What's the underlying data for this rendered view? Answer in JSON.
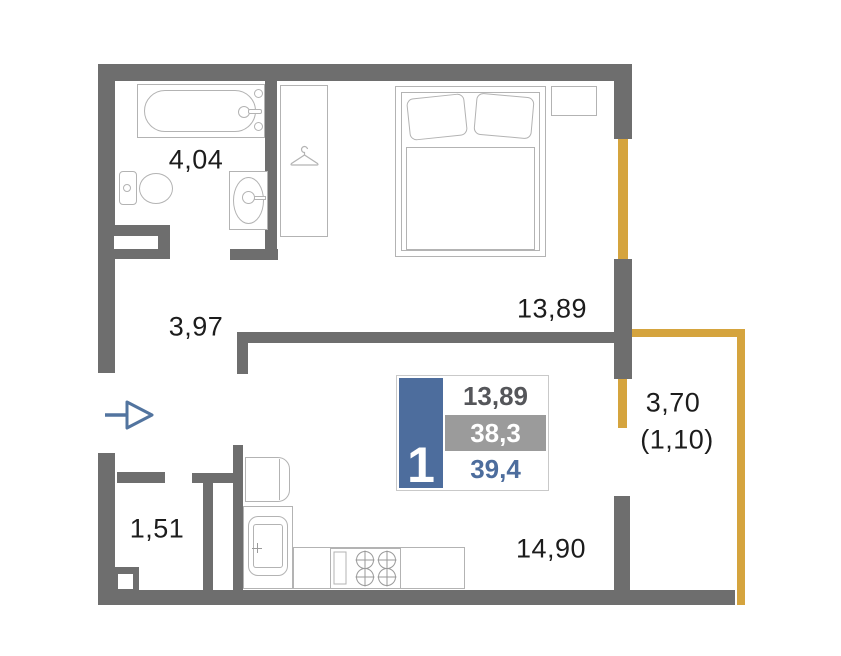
{
  "floorplan": {
    "labels": {
      "bathroom": "4,04",
      "hallway": "3,97",
      "bedroom": "13,89",
      "closet": "1,51",
      "kitchen_living": "14,90",
      "balcony": "3,70",
      "balcony_reduced": "(1,10)"
    },
    "badge": {
      "rooms": "1",
      "living_area": "13,89",
      "area_without_balcony": "38,3",
      "total_area": "39,4"
    },
    "colors": {
      "wall": "#6e6e6e",
      "window": "#d5a43e",
      "accent_blue": "#4d6d9d",
      "badge_gray": "#9b9b9b",
      "furniture_outline": "#b3b3b3",
      "text": "#1c1c1c",
      "entry_arrow": "#52749f"
    },
    "icons": [
      "bathtub-icon",
      "toilet-icon",
      "bath-sink-icon",
      "hanger-icon",
      "bed-icon",
      "nightstand-icon",
      "fridge-icon",
      "kitchen-sink-icon",
      "stove-icon",
      "entry-arrow-icon"
    ]
  }
}
